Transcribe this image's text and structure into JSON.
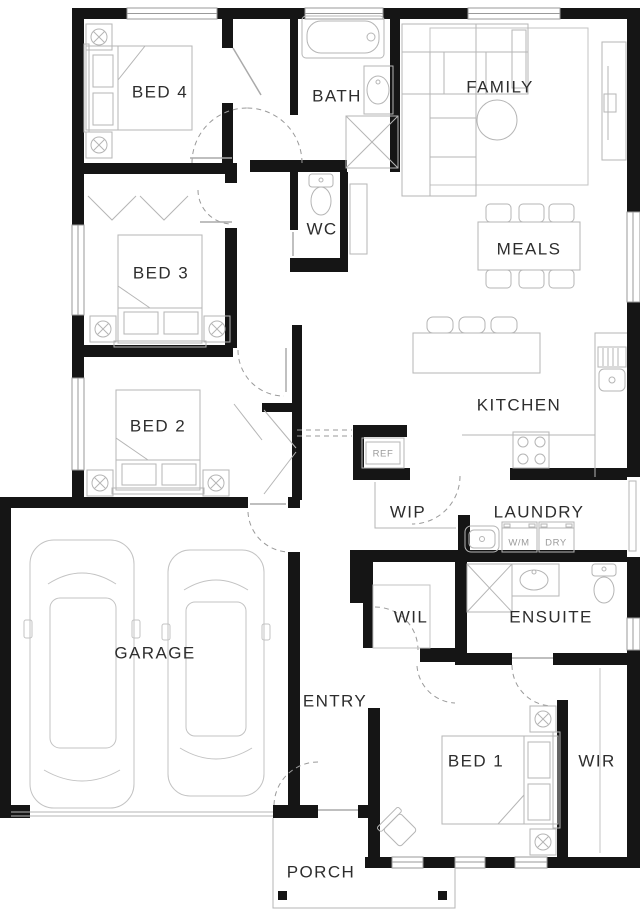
{
  "plan": {
    "title": "house-floor-plan",
    "rooms": {
      "bed4": "BED 4",
      "bath": "BATH",
      "family": "FAMILY",
      "wc": "WC",
      "bed3": "BED 3",
      "meals": "MEALS",
      "bed2": "BED 2",
      "kitchen": "KITCHEN",
      "wip": "WIP",
      "laundry": "LAUNDRY",
      "wil": "WIL",
      "ensuite": "ENSUITE",
      "garage": "GARAGE",
      "entry": "ENTRY",
      "bed1": "BED 1",
      "wir": "WIR",
      "porch": "PORCH"
    },
    "fixtures": {
      "fridge": "REF",
      "washing_machine": "W/M",
      "dryer": "DRY"
    },
    "colors": {
      "background": "#ffffff",
      "wall": "#151515",
      "furniture_line": "#b5b5b5",
      "room_label": "#2d2d2d",
      "fixture_label": "#9b9b9b",
      "door_arc": "#9a9a9a"
    }
  }
}
